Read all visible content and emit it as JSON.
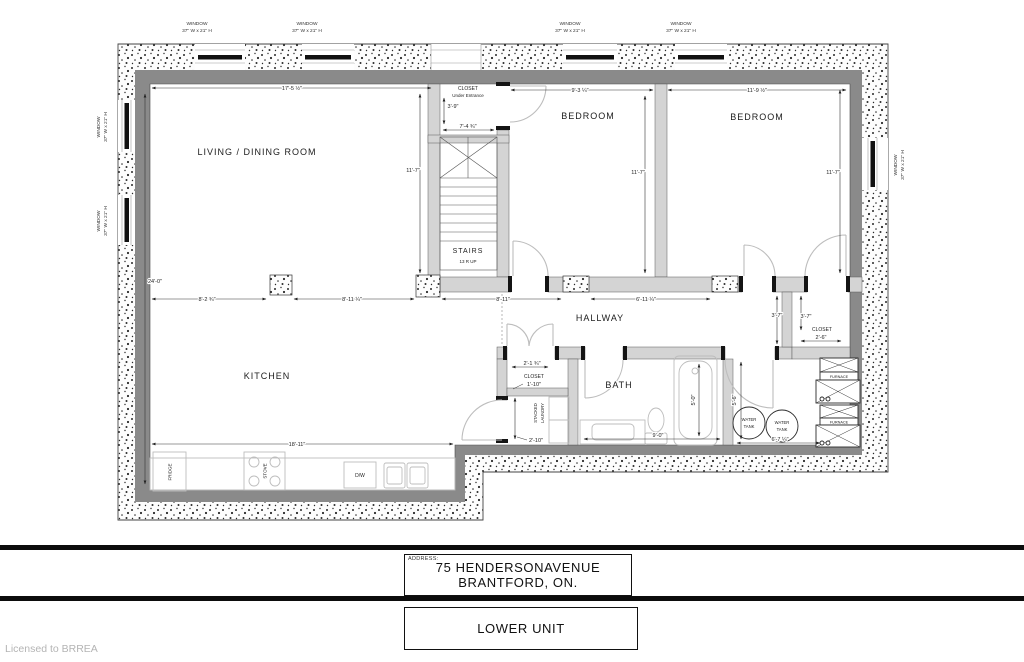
{
  "windows": {
    "label_line1": "WINDOW",
    "label_line2": "37\" W x 21\" H"
  },
  "rooms": {
    "living": "LIVING /  DINING ROOM",
    "bedroom1": "BEDROOM",
    "bedroom2": "BEDROOM",
    "kitchen": "KITCHEN",
    "hallway": "HALLWAY",
    "bath": "BATH",
    "stairs_label": "STAIRS",
    "stairs_note": "13 R UP",
    "entr_closet_line1": "CLOSET",
    "entr_closet_line2": "Under Entrance",
    "hall_closet": "CLOSET",
    "right_closet": "CLOSET",
    "laundry_line1": "STACKED",
    "laundry_line2": "LAUNDRY"
  },
  "fixtures": {
    "fridge": "FRIDGE",
    "stove": "STOVE",
    "dishwasher": "D/W",
    "water_tank_line1": "WATER",
    "water_tank_line2": "TANK",
    "furnace": "FURNACE"
  },
  "dims": {
    "living_width": "17'-5 ½\"",
    "living_height": "24'-0\"",
    "living_right": "11'-7\"",
    "bedroom1_width": "9'-3 ¼\"",
    "bedroom1_height": "11'-7\"",
    "bedroom2_width": "11'-9 ½\"",
    "bedroom2_height": "11'-7\"",
    "entr_closet_depth": "3'-9\"",
    "entr_closet_width": "7'-4 ¾\"",
    "span1": "8'-2 ¾\"",
    "span2": "8'-11 ¼\"",
    "span3": "8'-11\"",
    "span4": "6'-11 ¼\"",
    "closet_right_d1": "3'-7\"",
    "closet_right_d2": "3'-7\"",
    "closet_right_width": "2'-6\"",
    "utility_height": "5'-6\"",
    "utility_width": "6'-7 ¼\"",
    "bath_height": "5'-0\"",
    "bath_width": "9'-0\"",
    "hall_closet_width": "2'-1 ¾\"",
    "hall_closet_depth": "1'-10\"",
    "laundry_depth": "2'-10\"",
    "kitchen_width": "18'-11\""
  },
  "title_block": {
    "address_label": "ADDRESS:",
    "address_line1": "75 HENDERSONAVENUE",
    "address_line2": "BRANTFORD, ON.",
    "unit_label": "LOWER UNIT"
  },
  "watermark": "Licensed to BRREA"
}
